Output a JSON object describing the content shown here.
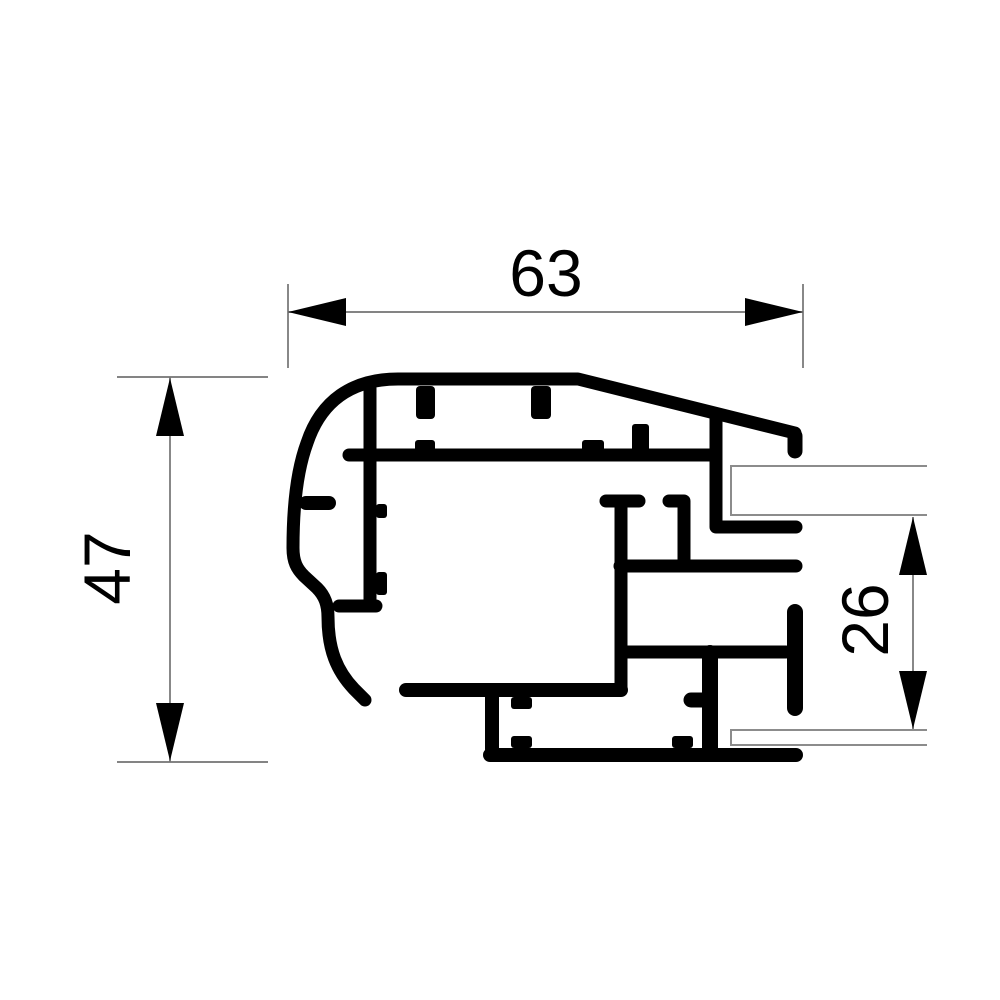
{
  "drawing": {
    "background_color": "#ffffff",
    "profile_color": "#000000",
    "dimension_line_color": "#737373",
    "glass_line_color": "#8c8c8c",
    "text_color": "#000000",
    "dimensions": {
      "width": {
        "label": "63",
        "orientation": "horizontal",
        "position": "top"
      },
      "height": {
        "label": "47",
        "orientation": "vertical",
        "position": "left"
      },
      "glazing_gap": {
        "label": "26",
        "orientation": "vertical",
        "position": "right"
      }
    }
  }
}
